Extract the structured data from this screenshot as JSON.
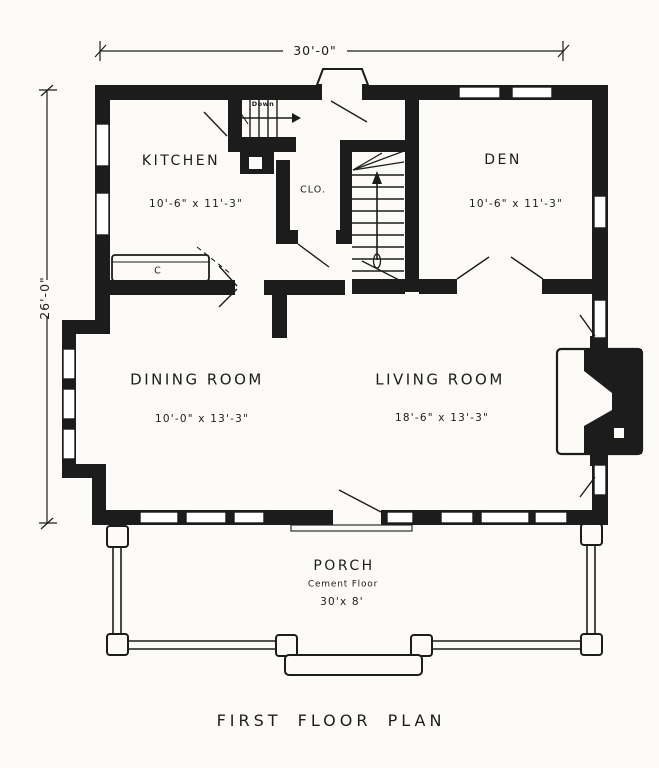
{
  "plan": {
    "caption": "FIRST FLOOR PLAN",
    "dim_width": "30'-0\"",
    "dim_height": "26'-0\""
  },
  "rooms": {
    "kitchen": {
      "name": "KITCHEN",
      "size": "10'-6\" x 11'-3\""
    },
    "den": {
      "name": "DEN",
      "size": "10'-6\" x 11'-3\""
    },
    "dining": {
      "name": "DINING ROOM",
      "size": "10'-0\" x 13'-3\""
    },
    "living": {
      "name": "LIVING ROOM",
      "size": "18'-6\" x 13'-3\""
    },
    "closet": {
      "name": "CLO."
    },
    "porch": {
      "name": "PORCH",
      "floor": "Cement Floor",
      "size": "30'x 8'"
    }
  },
  "annotations": {
    "stairs_down": "Down",
    "counter": "C"
  },
  "colors": {
    "ink": "#1c1c1c",
    "paper": "#fcfbf8"
  }
}
